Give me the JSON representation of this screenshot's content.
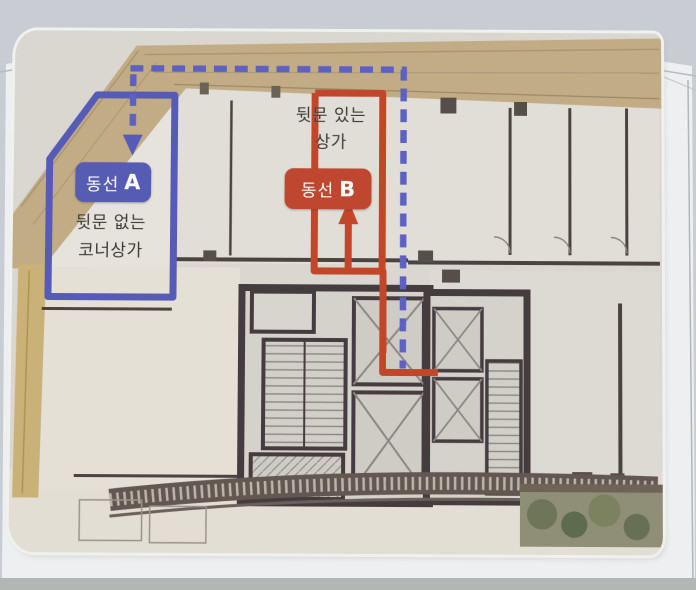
{
  "diagram": {
    "type": "floor-plan-route-comparison",
    "route_a": {
      "badge_prefix": "동선",
      "badge_letter": "A",
      "description_line1": "뒷문 없는",
      "description_line2": "코너상가",
      "color": "#565bb3",
      "line_style": "dashed-and-solid-outline"
    },
    "route_b": {
      "badge_prefix": "동선",
      "badge_letter": "B",
      "description_line1": "뒷문 있는",
      "description_line2": "상가",
      "color": "#bf4730",
      "line_style": "solid"
    }
  }
}
